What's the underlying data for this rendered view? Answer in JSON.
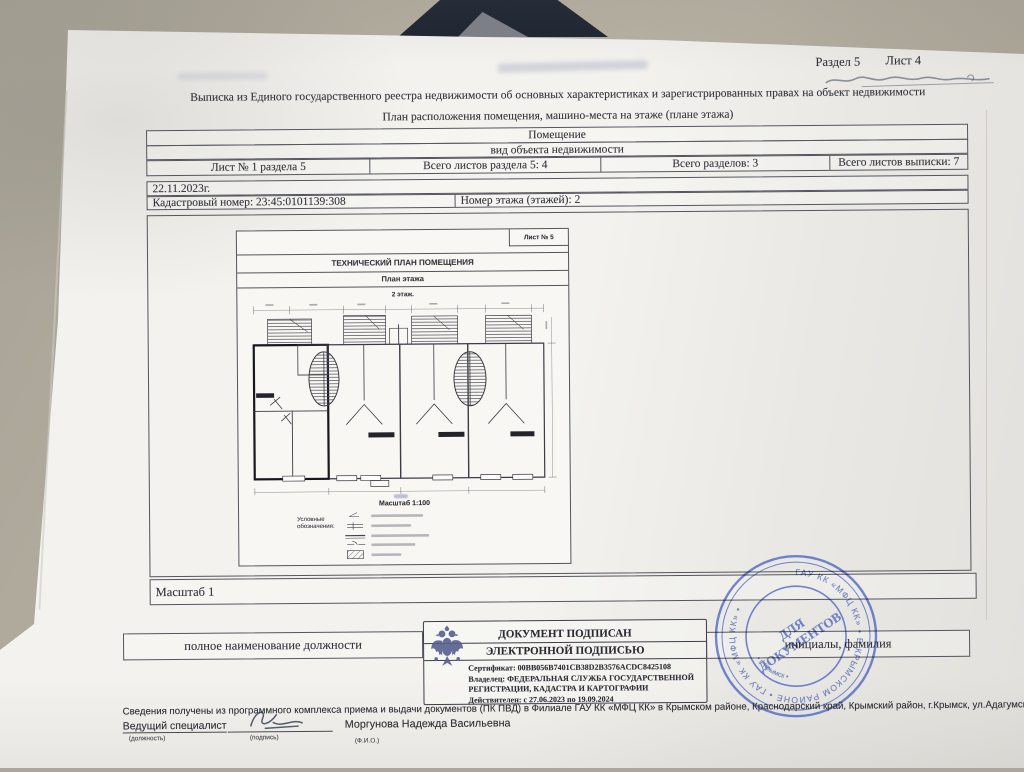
{
  "colors": {
    "ink": "#34333b",
    "stamp_blue": "#4d68c4",
    "paper": "#f3f2ee"
  },
  "header": {
    "section": "Раздел 5",
    "sheet": "Лист 4"
  },
  "title": "Выписка из Единого государственного реестра недвижимости об основных характеристиках и зарегистрированных правах на объект недвижимости",
  "subtitle": "План расположения помещения, машино-места на этаже (плане этажа)",
  "info_table": {
    "object_kind": "Помещение",
    "object_kind_caption": "вид объекта недвижимости",
    "cells": [
      "Лист № 1 раздела 5",
      "Всего листов раздела 5: 4",
      "Всего разделов: 3",
      "Всего листов выписки: 7"
    ],
    "date": "22.11.2023г.",
    "cadastral": "Кадастровый номер: 23:45:0101139:308",
    "floor": "Номер этажа (этажей): 2"
  },
  "plan_sheet": {
    "sheet_no": "Лист № 5",
    "title": "ТЕХНИЧЕСКИЙ ПЛАН ПОМЕЩЕНИЯ",
    "subtitle": "План этажа",
    "floor_label": "2 этаж.",
    "scale": "Масштаб 1:100",
    "legend_title": "Условные обозначения:"
  },
  "scale_row": "Масштаб 1",
  "signature": {
    "position_caption": "полное наименование должности",
    "name_caption": "инициалы, фамилия"
  },
  "esign": {
    "line1": "ДОКУМЕНТ ПОДПИСАН",
    "line2": "ЭЛЕКТРОННОЙ ПОДПИСЬЮ",
    "certificate": "Сертификат: 00BB056B7401CB38D2B3576ACDC8425108",
    "owner_line1": "Владелец: ФЕДЕРАЛЬНАЯ СЛУЖБА ГОСУДАРСТВЕННОЙ",
    "owner_line2": "РЕГИСТРАЦИИ, КАДАСТРА И КАРТОГРАФИИ",
    "valid": "Действителен: с 27.06.2023 по 19.09.2024"
  },
  "stamp": {
    "center_line1": "ДЛЯ",
    "center_line2": "ДОКУМЕНТОВ",
    "ring_text": "ГАУ КК «МФЦ КК»  •  В КРЫМСКОМ РАЙОНЕ  •  ГАУ КК «МФЦ КК»  •",
    "inner_text": "•  г. Крымск  •"
  },
  "footer": {
    "info": "Сведения получены из программного комплекса приема и выдачи документов (ПК ПВД) в Филиале ГАУ КК «МФЦ КК» в Крымском районе, Краснодарский край, Крымский район, г.Крымск, ул.Адагумская 153.",
    "specialist_label": "Ведущий специалист",
    "specialist_name": "Моргунова Надежда Васильевна",
    "caption_position": "(должность)",
    "caption_sign": "(подпись)",
    "caption_fio": "(Ф.И.О.)"
  }
}
